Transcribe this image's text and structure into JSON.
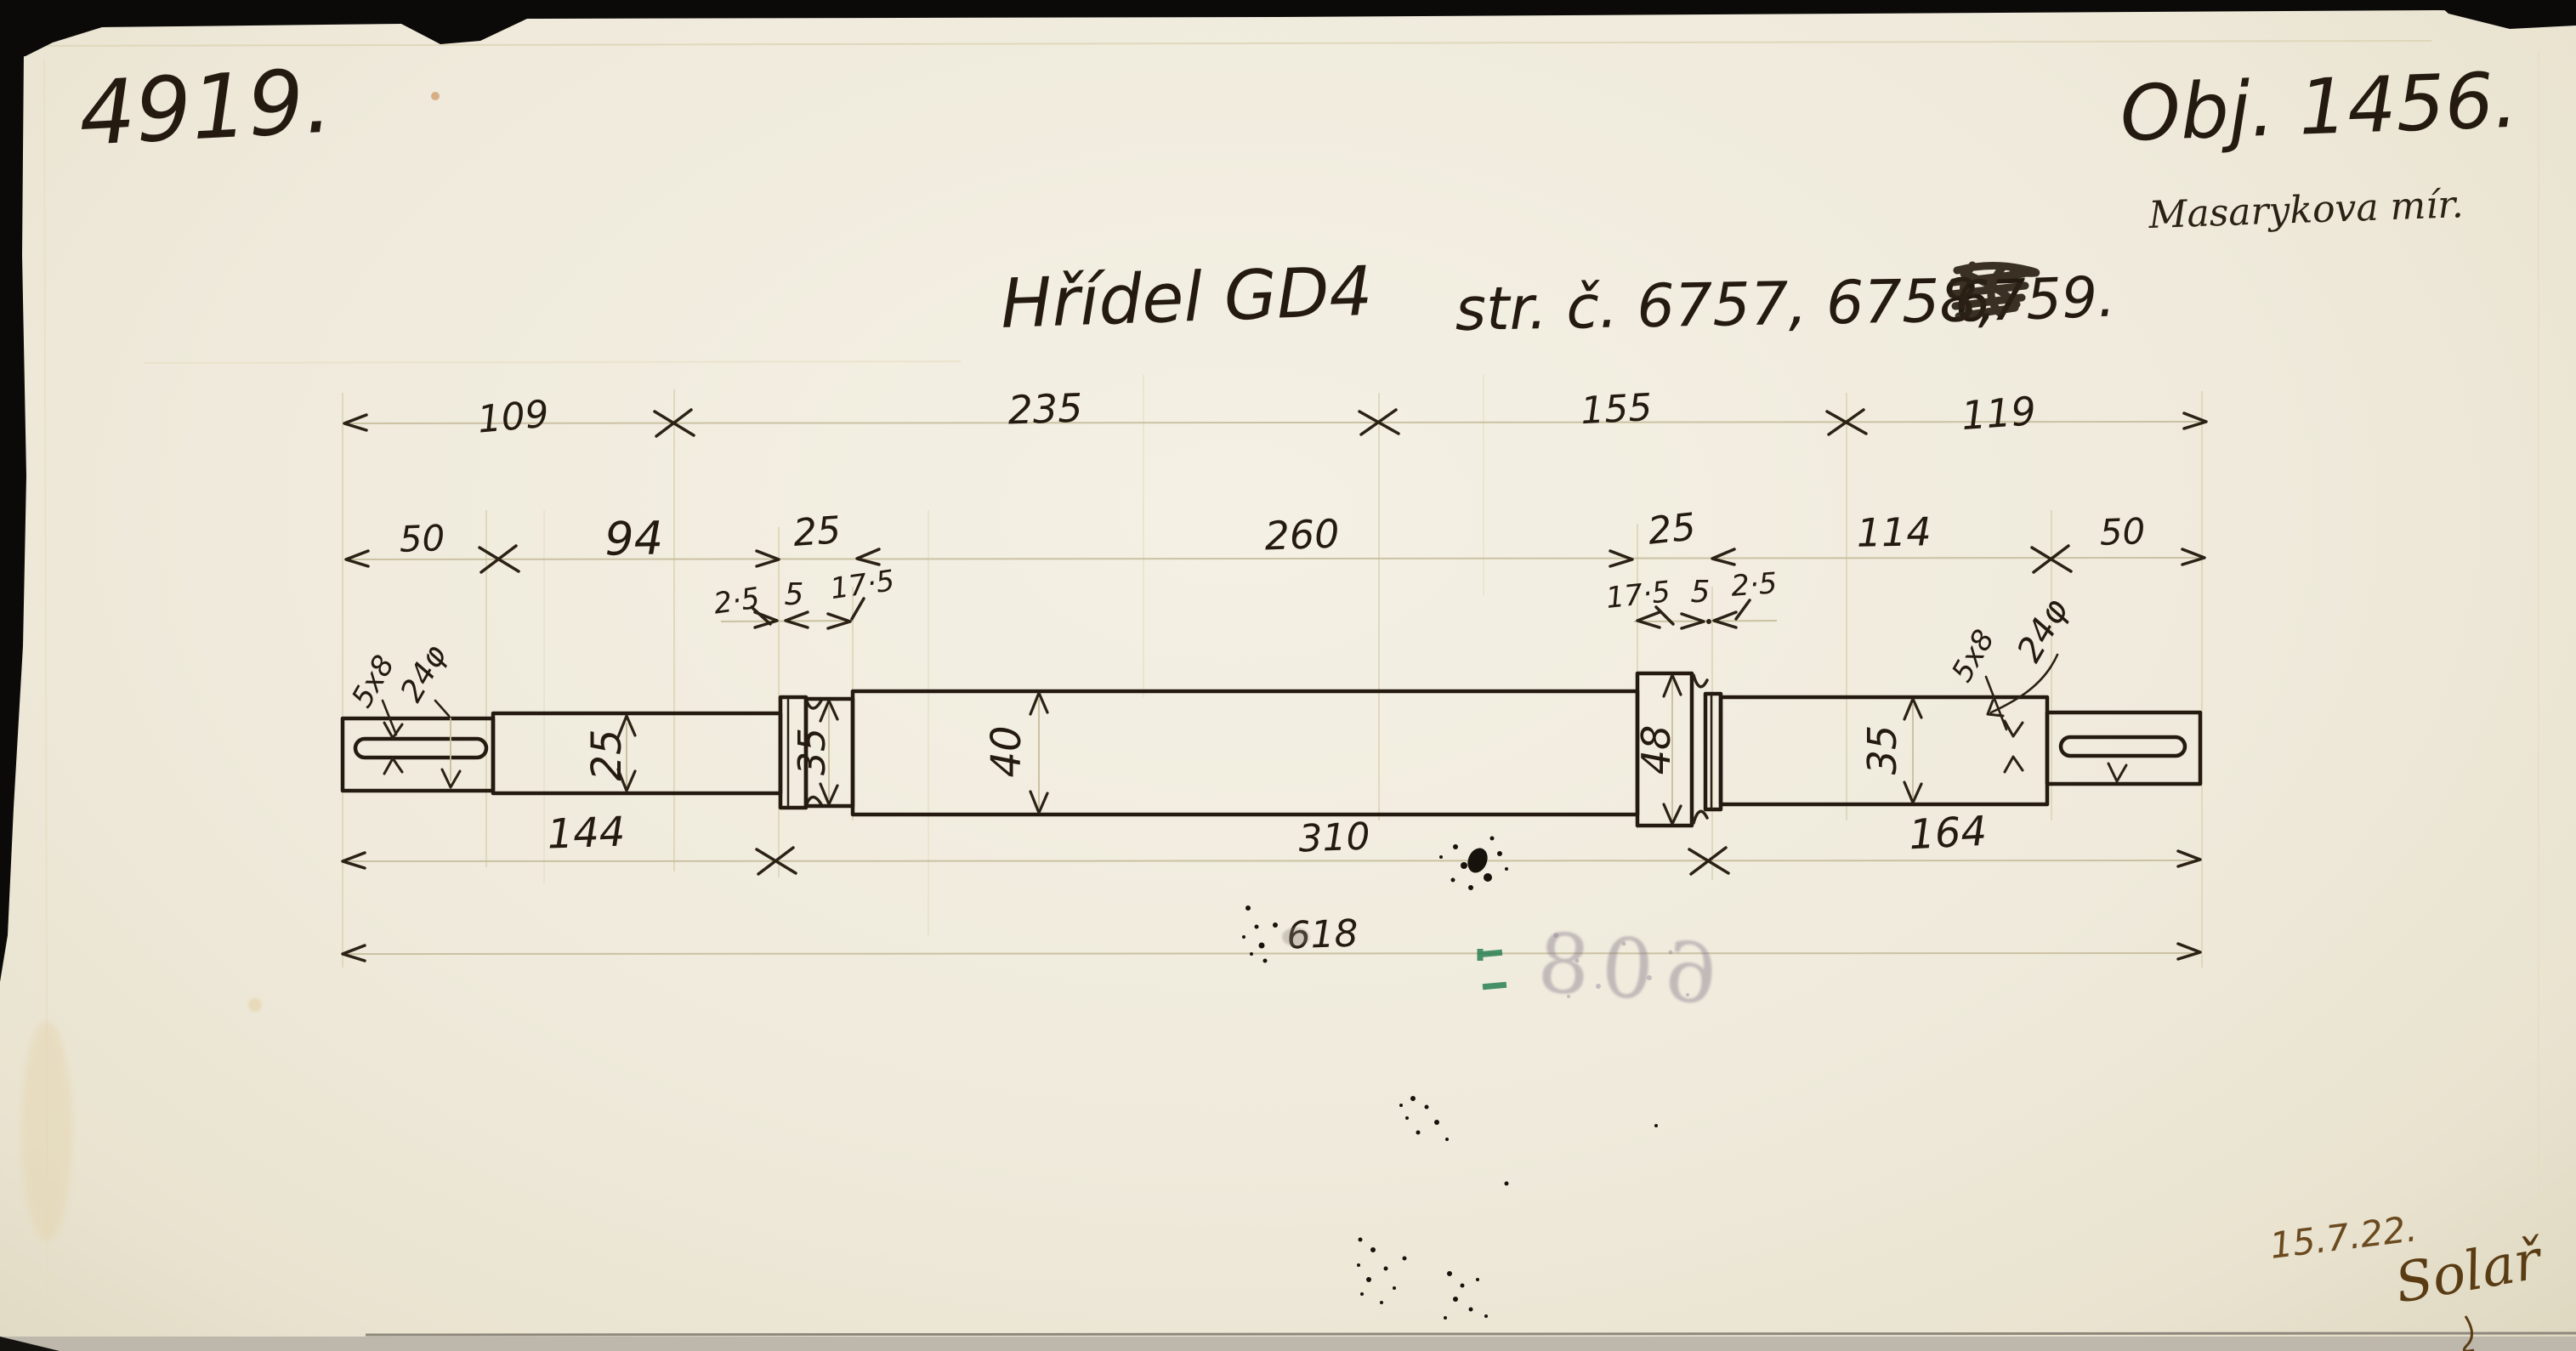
{
  "sheet": {
    "number": "4919.",
    "order_number": "Obj. 1456.",
    "order_note": "Masarykova mír.",
    "date": "15.7.22.",
    "signature": "Solař",
    "stamp_number": "608"
  },
  "title": {
    "main": "Hřídel GD4",
    "refs": "str. č. 6757, 6758,",
    "struck": "6759."
  },
  "dims": {
    "top": [
      "109",
      "235",
      "155",
      "119"
    ],
    "row2": [
      "50",
      "94",
      "25",
      "260",
      "25",
      "114",
      "50"
    ],
    "sub_left": [
      "2·5",
      "5",
      "17·5"
    ],
    "sub_right": [
      "17·5",
      "5",
      "2·5"
    ],
    "bottom": [
      "144",
      "310",
      "164"
    ],
    "total": "618",
    "dia": [
      "25",
      "35",
      "40",
      "48",
      "35"
    ],
    "keyway_left": "5x8",
    "keyway_right": "5x8",
    "end_dia_left": "24φ",
    "end_dia_right": "24φ"
  }
}
